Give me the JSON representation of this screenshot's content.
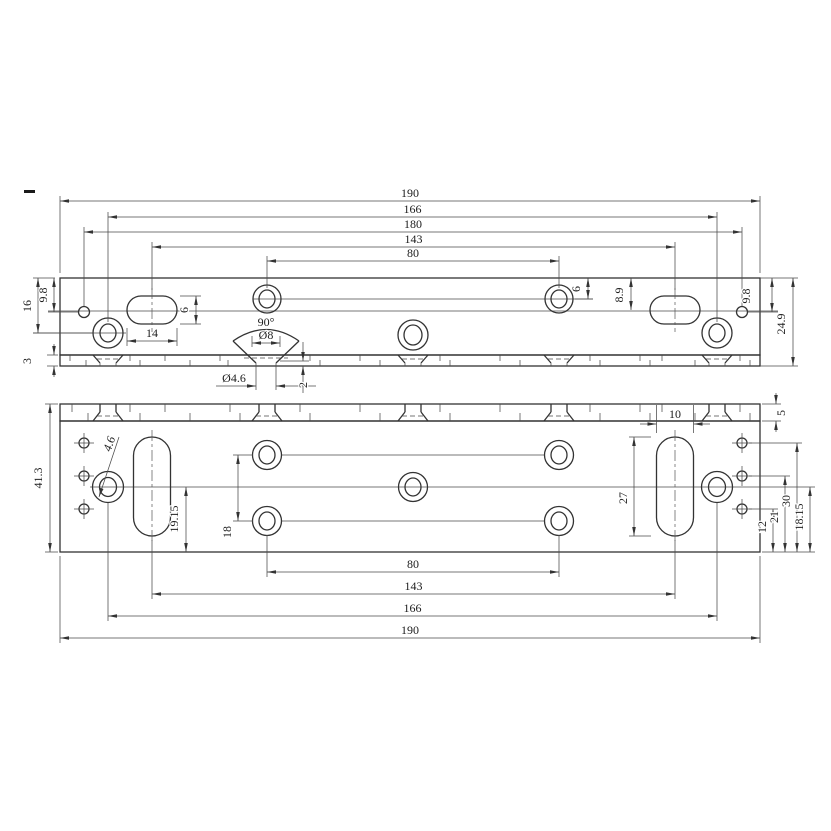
{
  "drawing_title": "Mounting plate – two orthographic views",
  "top_view": {
    "h_dims": [
      "190",
      "166",
      "180",
      "143",
      "80"
    ],
    "left": {
      "h16": "16",
      "h98": "9.8",
      "t3": "3"
    },
    "right": {
      "r6": "6",
      "r89": "8.9",
      "r98": "9.8",
      "r249": "24.9"
    },
    "slot": {
      "w": "14",
      "h": "6"
    },
    "cs": {
      "angle": "90°",
      "top": "Ø8",
      "hole": "Ø4.6",
      "depth": "2"
    }
  },
  "bottom_view": {
    "h_dims": [
      "80",
      "143",
      "166",
      "190"
    ],
    "height": "41.3",
    "leader": "4.6",
    "slot": {
      "len": "27",
      "w": "10"
    },
    "v": {
      "d1915": "19.15",
      "d18": "18"
    },
    "right": {
      "d5": "5",
      "d12": "12",
      "d21": "21",
      "d30": "30",
      "d1815": "18.15"
    }
  }
}
